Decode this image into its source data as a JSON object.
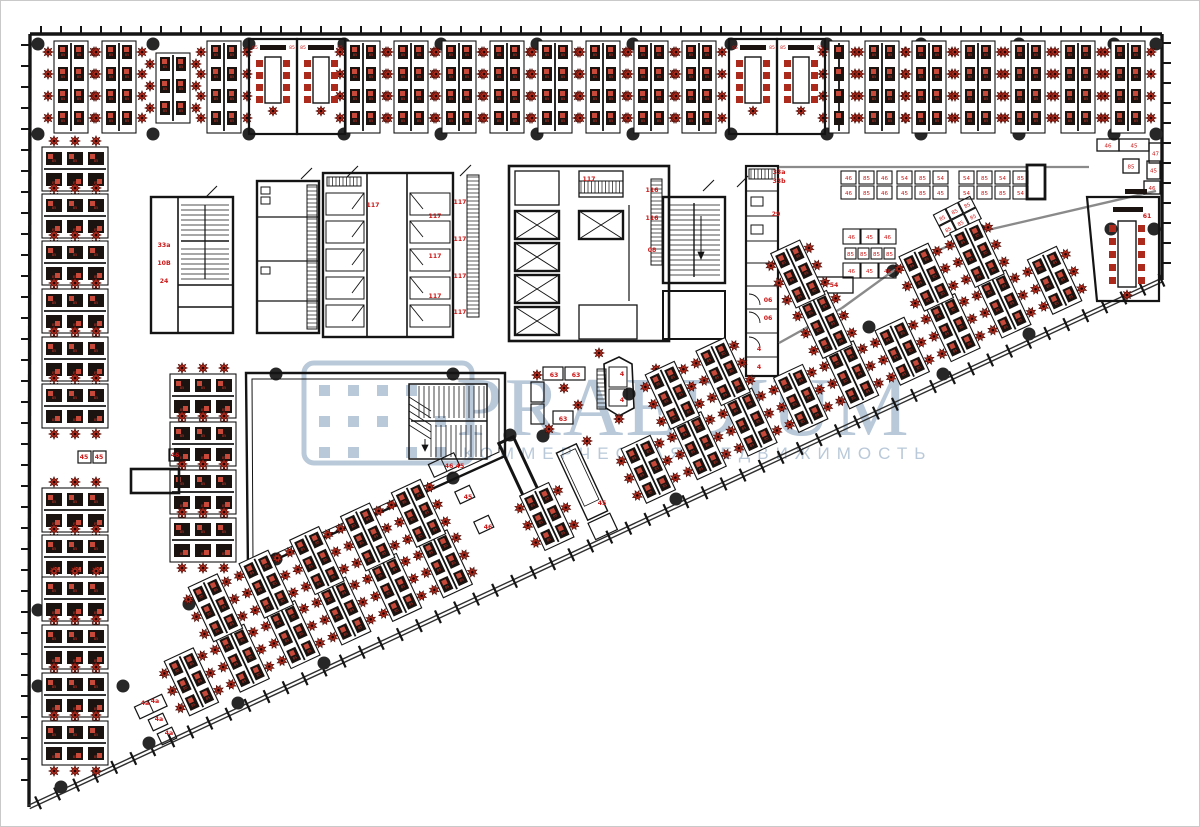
{
  "watermark": {
    "brand": "PRAEDIUM",
    "tagline": "КОММЕРЧЕСКАЯ НЕДВИЖИМОСТЬ",
    "color": "#b9c9d9"
  },
  "palette": {
    "wall": "#141414",
    "light_wall": "#8a8a8a",
    "chair": "#ab2a1c",
    "chair_dark": "#490b06",
    "desk": "#1a1310",
    "paper": "#c6493a",
    "red_label": "#cc1717",
    "column": "#272727",
    "facade": "#2f2f2f",
    "background": "#ffffff"
  },
  "floorplan": {
    "outline": {
      "top_left": [
        29,
        33
      ],
      "top_right": [
        1161,
        33
      ],
      "right_end": [
        1161,
        279
      ],
      "bottom_left": [
        28,
        806
      ]
    },
    "desk_number": "85",
    "columns": {
      "xs": [
        37,
        152,
        248,
        343,
        440,
        536,
        632,
        730,
        826,
        920,
        1018,
        1113,
        1155
      ],
      "rows_y": [
        43,
        133
      ],
      "extra": [
        [
          978,
          229
        ],
        [
          1110,
          228
        ],
        [
          1153,
          228
        ],
        [
          892,
          270
        ],
        [
          275,
          373
        ],
        [
          452,
          373
        ],
        [
          452,
          477
        ],
        [
          275,
          558
        ],
        [
          542,
          435
        ],
        [
          628,
          393
        ],
        [
          675,
          498
        ],
        [
          188,
          603
        ],
        [
          122,
          685
        ],
        [
          37,
          609
        ],
        [
          37,
          685
        ],
        [
          148,
          742
        ],
        [
          237,
          702
        ],
        [
          1028,
          333
        ],
        [
          942,
          373
        ],
        [
          509,
          434
        ],
        [
          323,
          662
        ],
        [
          60,
          786
        ],
        [
          716,
          353
        ],
        [
          868,
          326
        ]
      ]
    },
    "top_band": {
      "y": 40,
      "clusters": [
        {
          "cx": 70
        },
        {
          "cx": 118
        },
        {
          "cx": 172,
          "rows": 3,
          "y": 52
        },
        {
          "cx": 223
        },
        {
          "cx": 362
        },
        {
          "cx": 410
        },
        {
          "cx": 458
        },
        {
          "cx": 506
        },
        {
          "cx": 554
        },
        {
          "cx": 602
        },
        {
          "cx": 650
        },
        {
          "cx": 698
        },
        {
          "cx": 838,
          "w": 20
        },
        {
          "cx": 881
        },
        {
          "cx": 928
        },
        {
          "cx": 977
        },
        {
          "cx": 1027
        },
        {
          "cx": 1077
        },
        {
          "cx": 1127
        }
      ],
      "rooms": [
        248,
        296,
        728,
        776
      ]
    },
    "left_band": {
      "cx": 74,
      "ys": [
        168,
        215,
        262,
        310,
        358,
        405,
        509,
        556,
        598,
        646,
        694,
        742
      ],
      "mini_cx": 202,
      "mini_ys": [
        395,
        443,
        491,
        539
      ]
    },
    "diag": {
      "angle": -25,
      "A": [
        28,
        806
      ],
      "step": 56,
      "rows": [
        [
          45,
          200,
          1240,
          0
        ],
        [
          102,
          225,
          1240,
          28
        ],
        [
          159,
          250,
          1240,
          0
        ]
      ],
      "rejects": [
        [
          505,
          163,
          730,
          345
        ],
        [
          740,
          163,
          780,
          380
        ],
        [
          160,
          370,
          240,
          565
        ],
        [
          1085,
          188,
          1162,
          307
        ],
        [
          0,
          130,
          120,
          827
        ],
        [
          128,
          688,
          184,
          748
        ],
        [
          430,
          452,
          505,
          545
        ],
        [
          500,
          438,
          540,
          500
        ],
        [
          552,
          436,
          612,
          526
        ],
        [
          836,
          220,
          898,
          300
        ],
        [
          592,
          352,
          648,
          420
        ],
        [
          526,
          360,
          600,
          430
        ],
        [
          96,
          440,
          188,
          499
        ],
        [
          112,
          350,
          168,
          572
        ],
        [
          240,
          30,
          1162,
          160
        ],
        [
          1150,
          0,
          1200,
          827
        ]
      ],
      "amphi": {
        "x0": 240,
        "x1": 508,
        "y_top": 368,
        "p1": [
          248,
          570
        ],
        "p2": [
          503,
          453
        ]
      },
      "cafe_wall": [
        [
          841,
          307
        ],
        [
          892,
          270
        ],
        [
          978,
          231
        ],
        [
          1155,
          190
        ]
      ]
    },
    "cafe": {
      "pairs": {
        "y": 170,
        "w": 15,
        "h": 13,
        "items": [
          {
            "x": 840,
            "a": "46",
            "b": "46"
          },
          {
            "x": 858,
            "a": "85",
            "b": "85"
          },
          {
            "x": 876,
            "a": "46",
            "b": "46"
          },
          {
            "x": 896,
            "a": "54",
            "b": "45"
          },
          {
            "x": 914,
            "a": "85",
            "b": "85"
          },
          {
            "x": 932,
            "a": "54",
            "b": "45"
          },
          {
            "x": 958,
            "a": "54",
            "b": "54"
          },
          {
            "x": 976,
            "a": "85",
            "b": "85"
          },
          {
            "x": 994,
            "a": "54",
            "b": "85"
          },
          {
            "x": 1012,
            "a": "85",
            "b": "54"
          }
        ]
      },
      "mid_rows": [
        {
          "y": 228,
          "h": 15,
          "cells": [
            [
              842,
              17,
              "46"
            ],
            [
              860,
              17,
              "45"
            ],
            [
              878,
              17,
              "46"
            ]
          ]
        },
        {
          "y": 247,
          "h": 11,
          "cells": [
            [
              844,
              11,
              "85"
            ],
            [
              857,
              11,
              "85"
            ],
            [
              870,
              11,
              "85"
            ],
            [
              883,
              11,
              "85"
            ]
          ]
        },
        {
          "y": 262,
          "h": 15,
          "cells": [
            [
              842,
              17,
              "46"
            ],
            [
              860,
              17,
              "45"
            ],
            [
              878,
              17,
              "46"
            ]
          ]
        }
      ],
      "t54": [
        814,
        276,
        38,
        16,
        "54"
      ],
      "diamond": {
        "cx": 957,
        "cy": 216,
        "rot": -27,
        "labels": [
          "85",
          "85",
          "85",
          "85",
          "85",
          "85"
        ]
      },
      "lcounter": [
        [
          1096,
          138,
          22,
          12,
          "46"
        ],
        [
          1118,
          138,
          30,
          12,
          "45"
        ],
        [
          1148,
          142,
          13,
          20,
          "47"
        ],
        [
          1122,
          158,
          16,
          14,
          "85"
        ],
        [
          1146,
          160,
          13,
          18,
          "45"
        ],
        [
          1143,
          180,
          16,
          13,
          "46"
        ]
      ]
    },
    "misc": {
      "left_tables": [
        [
          77,
          450,
          13,
          12
        ],
        [
          92,
          450,
          13,
          12
        ],
        [
          168,
          448,
          13,
          12
        ]
      ],
      "big_table": [
        130,
        468,
        48,
        24
      ],
      "stars": [
        [
          536,
          374
        ],
        [
          563,
          387
        ],
        [
          577,
          404
        ],
        [
          548,
          428
        ],
        [
          586,
          440
        ],
        [
          618,
          418
        ],
        [
          598,
          352
        ],
        [
          655,
          368
        ]
      ]
    },
    "labels": [
      [
        588,
        180,
        "117"
      ],
      [
        459,
        203,
        "117"
      ],
      [
        459,
        240,
        "117"
      ],
      [
        459,
        277,
        "117"
      ],
      [
        459,
        313,
        "117"
      ],
      [
        434,
        217,
        "117"
      ],
      [
        434,
        257,
        "117"
      ],
      [
        434,
        297,
        "117"
      ],
      [
        372,
        206,
        "117"
      ],
      [
        651,
        191,
        "116"
      ],
      [
        651,
        219,
        "116"
      ],
      [
        651,
        251,
        "08"
      ],
      [
        163,
        246,
        "33a"
      ],
      [
        163,
        264,
        "10B"
      ],
      [
        163,
        282,
        "24"
      ],
      [
        778,
        173,
        "33a"
      ],
      [
        778,
        182,
        "33b"
      ],
      [
        775,
        215,
        "29"
      ],
      [
        767,
        301,
        "06"
      ],
      [
        767,
        319,
        "06"
      ],
      [
        758,
        350,
        "4"
      ],
      [
        758,
        368,
        "4"
      ],
      [
        833,
        286,
        "54"
      ],
      [
        601,
        504,
        "45"
      ],
      [
        553,
        376,
        "63"
      ],
      [
        575,
        376,
        "63"
      ],
      [
        562,
        420,
        "63"
      ],
      [
        621,
        375,
        "4"
      ],
      [
        621,
        401,
        "4"
      ],
      [
        448,
        467,
        "46"
      ],
      [
        459,
        467,
        "45"
      ],
      [
        467,
        498,
        "45"
      ],
      [
        487,
        528,
        "46"
      ],
      [
        144,
        704,
        "4a"
      ],
      [
        154,
        702,
        "4a"
      ],
      [
        158,
        720,
        "4a"
      ],
      [
        168,
        734,
        "4a"
      ],
      [
        83,
        458,
        "45"
      ],
      [
        98,
        458,
        "45"
      ],
      [
        174,
        456,
        "46"
      ],
      [
        1146,
        217,
        "61"
      ]
    ]
  }
}
